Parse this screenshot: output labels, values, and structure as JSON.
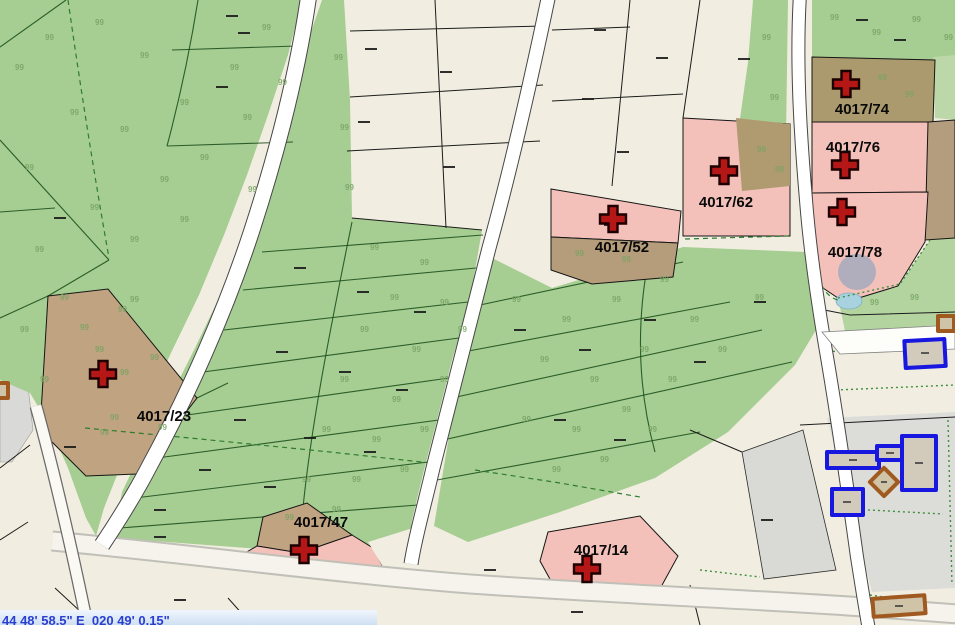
{
  "map": {
    "tree_glyph": "99",
    "parcel_labels": [
      {
        "label": "4017/74"
      },
      {
        "label": "4017/76"
      },
      {
        "label": "4017/78"
      },
      {
        "label": "4017/62"
      },
      {
        "label": "4017/52"
      },
      {
        "label": "4017/23"
      },
      {
        "label": "4017/47"
      },
      {
        "label": "4017/14"
      }
    ],
    "statusbar": {
      "lat": "44 48' 58.5\"",
      "lon": "E  020 49' 0.15\""
    },
    "colors": {
      "forest_green": "#a6cd92",
      "light_green": "#bcd8a8",
      "boundary_green": "#1e521e",
      "beige": "#f1eee1",
      "highlight_pink": "#f4c1ba",
      "tan": "#c0a381",
      "khaki": "#ab9a6d",
      "cross_red": "#b51717",
      "building_blue": "#1717e0",
      "building_brown": "#a05a20",
      "water_blue": "#a8d2e0",
      "status_text_blue": "#2a3fd0",
      "road_white": "#ffffff",
      "gray_yard": "#dcdcd8"
    }
  }
}
